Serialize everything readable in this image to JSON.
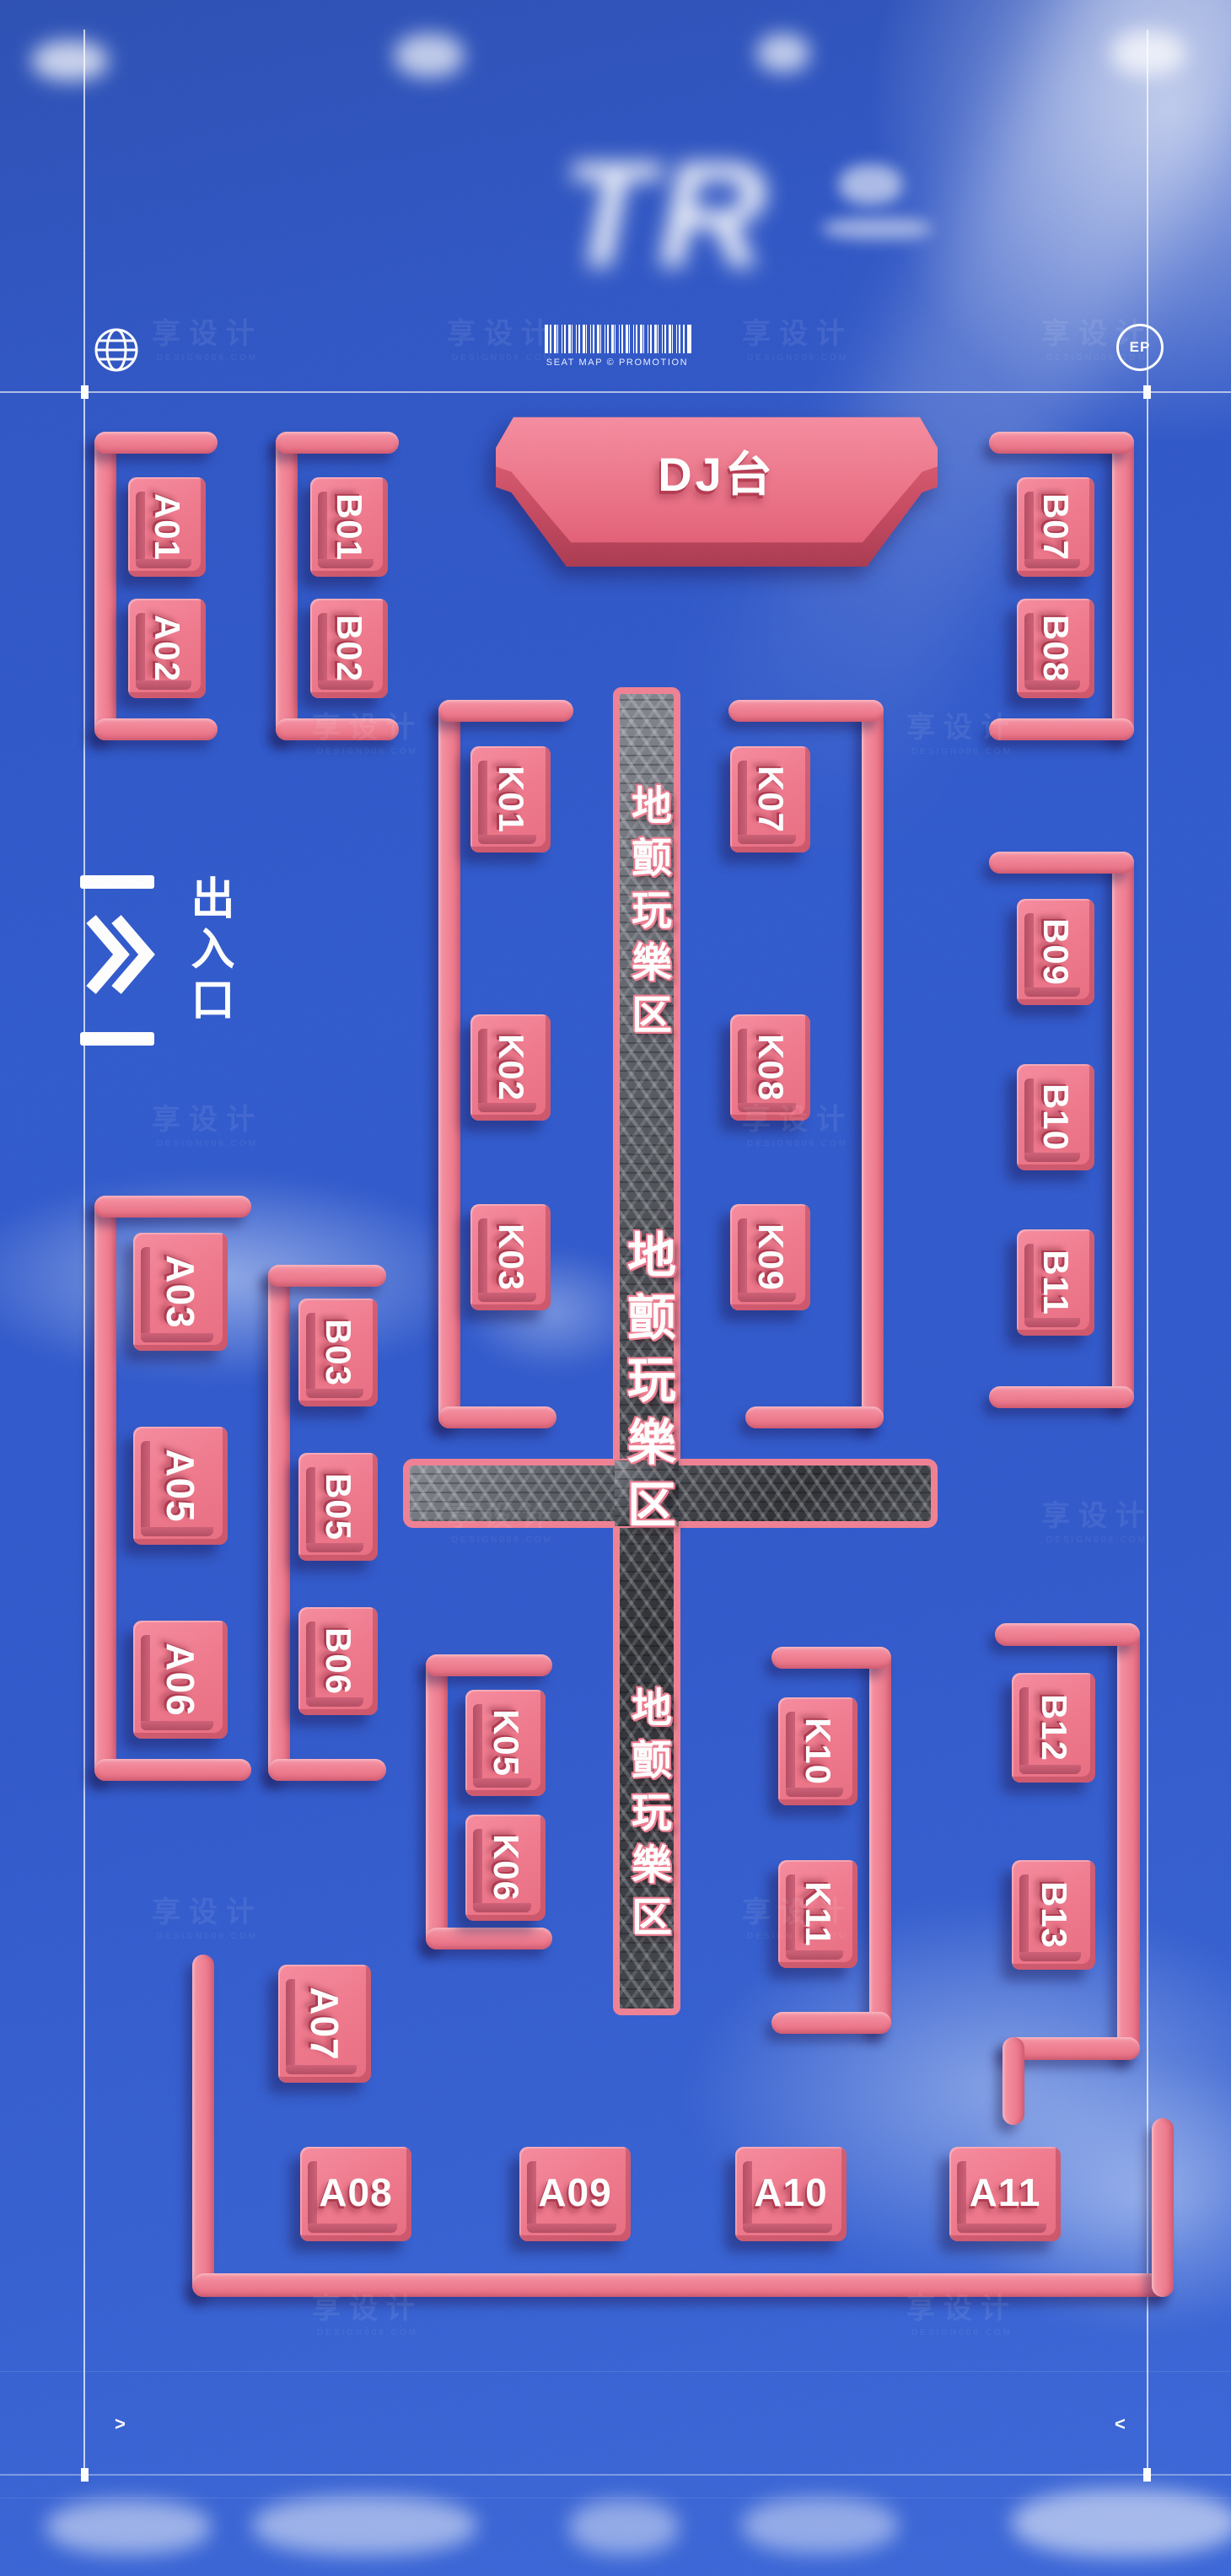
{
  "watermark": {
    "text": "享设计",
    "subtext": "DESIGN006.COM"
  },
  "header": {
    "logo_text": "TR",
    "barcode_caption": "SEAT MAP © PROMOTION",
    "ep_badge_label": "EP"
  },
  "stage_label": "DJ台",
  "entrance_label": "出入口",
  "walkway_label": "地颤玩樂区",
  "corner_marks": {
    "left": ">",
    "right": "<"
  },
  "colors": {
    "background_blue": "#2f58cb",
    "seat_pink": "#f0788c",
    "seat_ridge_dark": "#b44c62",
    "bracket_pink": "#f08093",
    "stage_pink": "#ee6e84",
    "metal_dark": "#3a3d44",
    "text_white": "#ffffff"
  },
  "seats": {
    "A01": "A01",
    "A02": "A02",
    "B01": "B01",
    "B02": "B02",
    "B07": "B07",
    "B08": "B08",
    "K01": "K01",
    "K02": "K02",
    "K03": "K03",
    "K07": "K07",
    "K08": "K08",
    "K09": "K09",
    "B09": "B09",
    "B10": "B10",
    "B11": "B11",
    "A03": "A03",
    "A05": "A05",
    "A06": "A06",
    "B03": "B03",
    "B05": "B05",
    "B06": "B06",
    "K05": "K05",
    "K06": "K06",
    "K10": "K10",
    "K11": "K11",
    "B12": "B12",
    "B13": "B13",
    "A07": "A07",
    "A08": "A08",
    "A09": "A09",
    "A10": "A10",
    "A11": "A11"
  }
}
